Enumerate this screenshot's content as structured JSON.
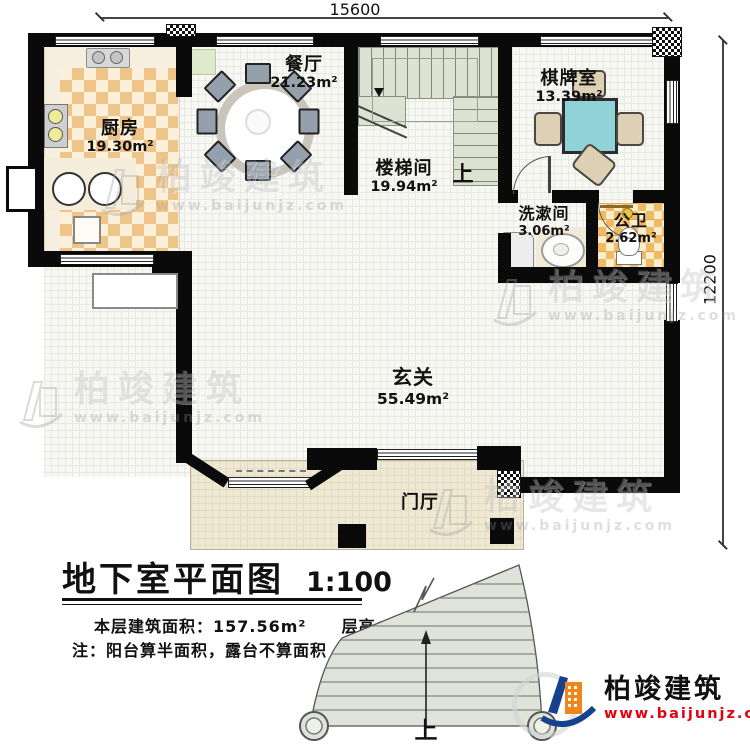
{
  "dimensions": {
    "width_mm": "15600",
    "height_mm": "12200"
  },
  "rooms": {
    "kitchen": {
      "name": "厨房",
      "area": "19.30m²"
    },
    "dining": {
      "name": "餐厅",
      "area": "21.23m²"
    },
    "stairwell": {
      "name": "楼梯间",
      "area": "19.94m²",
      "up": "上"
    },
    "chess": {
      "name": "棋牌室",
      "area": "13.39m²"
    },
    "washroom": {
      "name": "洗漱间",
      "area": "3.06m²"
    },
    "bathroom": {
      "name": "公卫",
      "area": "2.62m²"
    },
    "hall": {
      "name": "玄关",
      "area": "55.49m²"
    },
    "foyer": {
      "name": "门厅"
    }
  },
  "exterior_stair": {
    "up": "上"
  },
  "title_block": {
    "title": "地下室平面图",
    "scale": "1:100",
    "area_label": "本层建筑面积：",
    "area_value": "157.56m²",
    "height_label": "层高：",
    "height_value": "2.1m",
    "note": "注：阳台算半面积，露台不算面积"
  },
  "branding": {
    "company": "柏竣建筑",
    "website": "www.baijunjz.com",
    "accent_blue": "#16418c",
    "accent_orange": "#f08519",
    "url_red": "#e60012"
  },
  "watermark": {
    "company": "柏竣建筑",
    "website": "www.baijunjz.com"
  }
}
